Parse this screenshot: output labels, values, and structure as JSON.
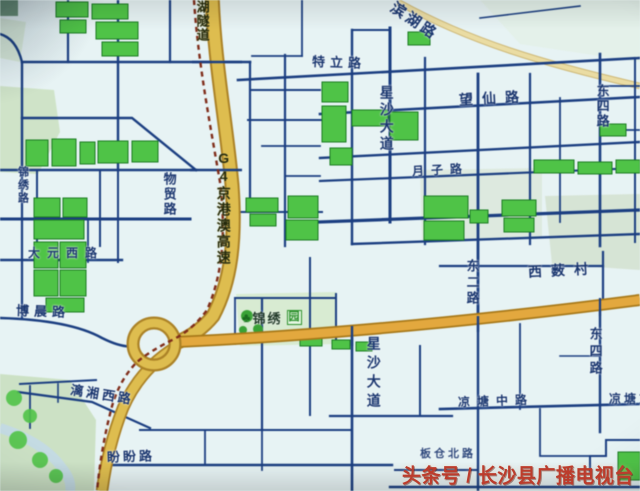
{
  "map_type": "street-map",
  "labels": {
    "binhu_lu": "滨湖路",
    "teli_lu": "特立路",
    "wangxian_lu": "望仙路",
    "xingsha_dadao_north": "星沙大道",
    "dongsi_lu_north": "东四路",
    "yuezi_lu": "月子路",
    "wumao_lu": "物贸路",
    "g4_expressway": "G4京港澳高速",
    "tunnel_partial": "湖隧道",
    "jinxiu_lu": "锦绣路",
    "dayuan_xilu": "大元西路",
    "bochen_lu": "博晨路",
    "jinxiu_yuan": "锦绣",
    "jinxiu_yuan_box": "园",
    "dong_er_lu": "东二路",
    "xisou_cun": "西薮村",
    "xingsha_dadao_south": "星沙大道",
    "dongsi_lu_south": "东四路",
    "liangtang_zhonglu": "凉塘中路",
    "liangtang_donglu_partial": "凉塘东路",
    "bancang_beilu": "板仓北路",
    "panpan_lu": "盼盼路",
    "lixiang_xilu": "漓湘西路"
  },
  "icons": {
    "park_tree": "♣"
  },
  "watermark": "头条号 / 长沙县广播电视台",
  "colors": {
    "background": "#e7f3f4",
    "street_blue": "#1d3e7d",
    "highway_fill": "#dcbd55",
    "highway_casing": "#a9822c",
    "orange_road": "#e0a844",
    "building_green": "#54c14c",
    "park_green": "#cfe2c8",
    "railway_red": "#7c2e1c",
    "label_navy": "#1a356b",
    "watermark_red": "#bc3c2c"
  }
}
